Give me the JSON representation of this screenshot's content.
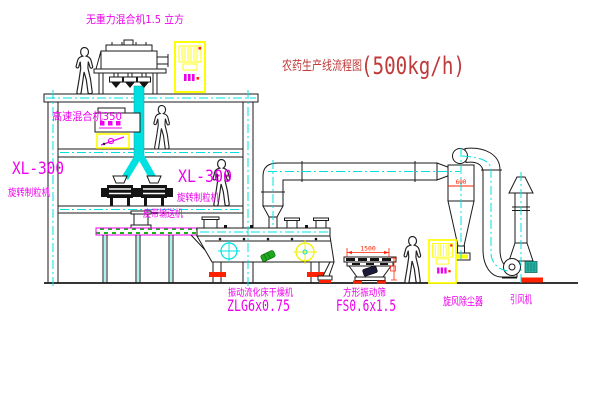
{
  "title": {
    "text_cn": "农药生产线流程图",
    "capacity": "(500kg/h)"
  },
  "labels": {
    "gravity_mixer": "无重力混合机1.5 立方",
    "high_speed_mixer": "高速混合机350",
    "granulator_left_model": "XL-300",
    "granulator_left_name": "旋转制粒机",
    "granulator_center_model": "XL-300",
    "granulator_center_name": "旋转制粒机",
    "belt_conveyor": "皮带输送机",
    "fluid_bed_dryer_name": "振动流化床干燥机",
    "fluid_bed_dryer_model": "ZLG6x0.75",
    "vibrating_screen_name": "方形振动筛",
    "vibrating_screen_model": "FS0.6x1.5",
    "cyclone_dust_collector": "旋风除尘器",
    "induced_draft_fan": "引风机"
  },
  "dimensions": {
    "screen_length": "1500",
    "cyclone_diameter": "600"
  },
  "colors": {
    "line": "#1a1a1a",
    "centerline_cyan": "#00e0e0",
    "label_magenta": "#ee00ee",
    "title_red": "#c03a3a",
    "highlight_yellow": "#ffff00",
    "accent_red": "#ff2200",
    "motor_green": "#1fa81f",
    "motor_teal": "#27b0a2"
  }
}
